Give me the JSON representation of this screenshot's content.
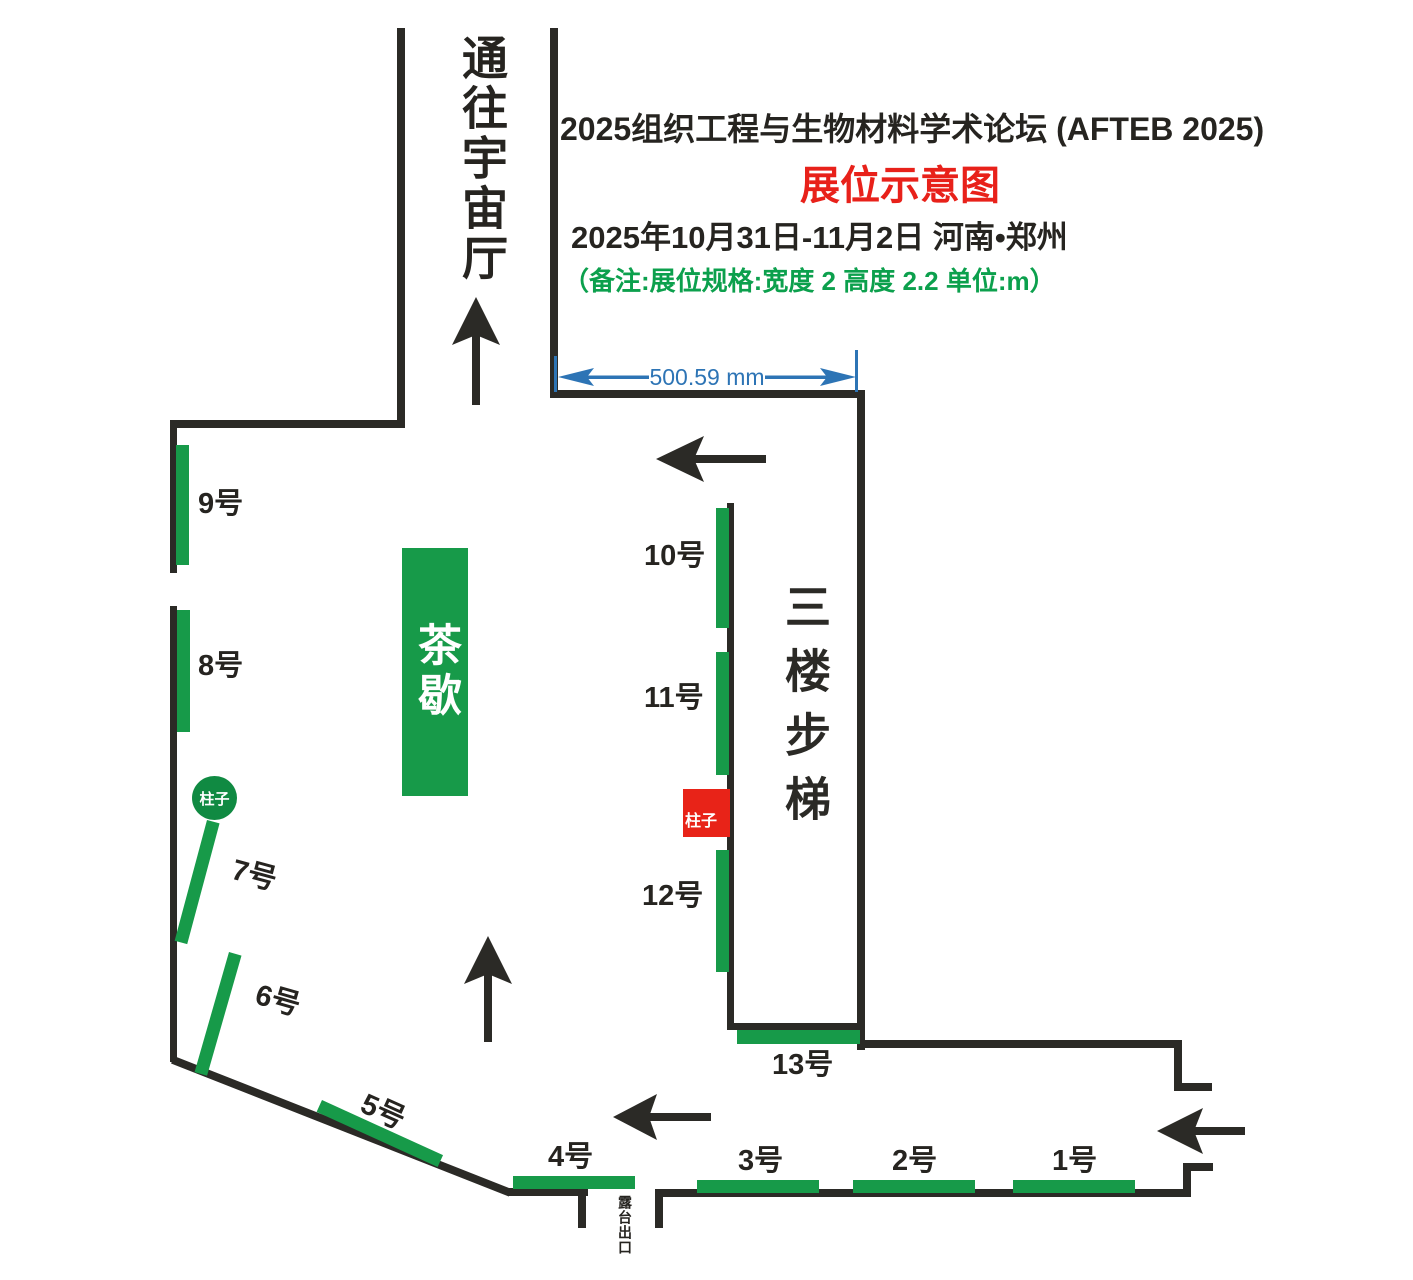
{
  "header": {
    "title": "2025组织工程与生物材料学术论坛 (AFTEB 2025)",
    "subtitle": "展位示意图",
    "date_location": "2025年10月31日-11月2日  河南•郑州",
    "note": "（备注:展位规格:宽度 2  高度 2.2  单位:m）"
  },
  "dimension": {
    "label": "500.59 mm"
  },
  "areas": {
    "corridor_label": "通往宇宙厅",
    "stairs_label": "三楼步梯",
    "tea_break_label": "茶歇",
    "terrace_exit_label": "露台出口",
    "pillar_round_label": "柱子",
    "pillar_square_label": "柱子"
  },
  "booths": [
    {
      "label": "1号"
    },
    {
      "label": "2号"
    },
    {
      "label": "3号"
    },
    {
      "label": "4号"
    },
    {
      "label": "5号"
    },
    {
      "label": "6号"
    },
    {
      "label": "7号"
    },
    {
      "label": "8号"
    },
    {
      "label": "9号"
    },
    {
      "label": "10号"
    },
    {
      "label": "11号"
    },
    {
      "label": "12号"
    },
    {
      "label": "13号"
    }
  ],
  "colors": {
    "booth_green": "#179a49",
    "wall_black": "#2b2a26",
    "accent_red": "#e8211a",
    "note_green": "#0ca04d",
    "dimension_blue": "#2d74b5",
    "pillar_red": "#e82318"
  }
}
